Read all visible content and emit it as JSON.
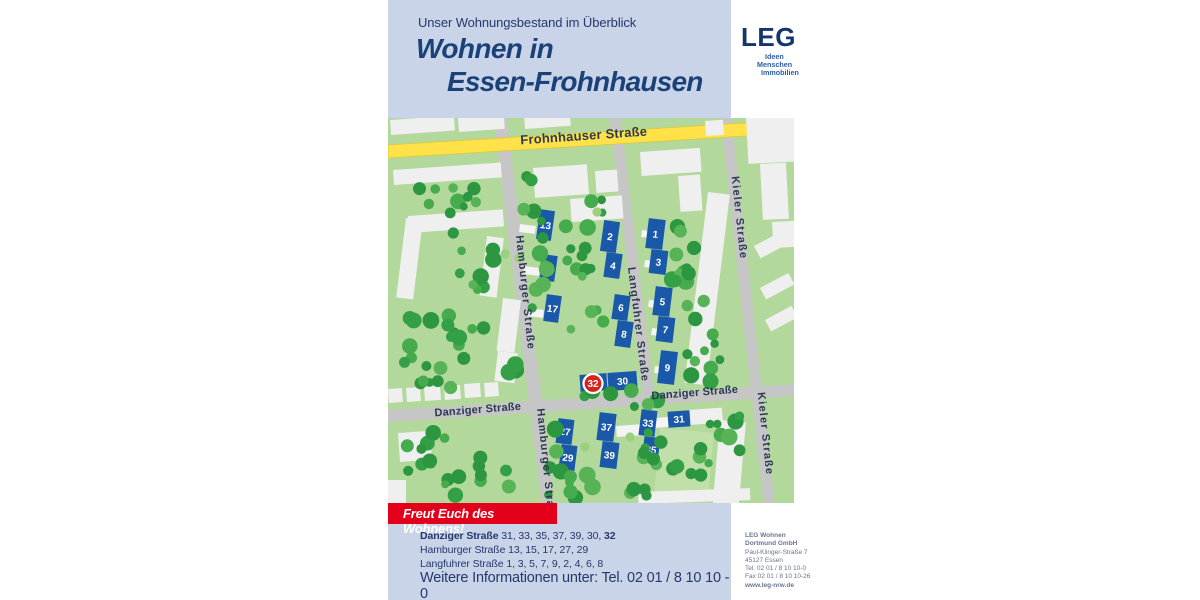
{
  "header": {
    "eyebrow": "Unser Wohnungsbestand im Überblick",
    "title_line1": "Wohnen in",
    "title_line2": "Essen-Frohnhausen"
  },
  "logo": {
    "name": "LEG",
    "tagline": [
      "Ideen",
      "Menschen",
      "Immobilien"
    ]
  },
  "map": {
    "street_labels": [
      {
        "text": "Frohnhauser Straße",
        "x": 196,
        "y": 22,
        "rot": -4,
        "size": 13,
        "main": true
      },
      {
        "text": "Hamburger Straße",
        "x": 134,
        "y": 175,
        "rot": 84,
        "size": 11
      },
      {
        "text": "Hamburger Straße",
        "x": 155,
        "y": 348,
        "rot": 84,
        "size": 11
      },
      {
        "text": "Langfuhrer Straße",
        "x": 247,
        "y": 207,
        "rot": 83,
        "size": 11
      },
      {
        "text": "Kieler Straße",
        "x": 348,
        "y": 100,
        "rot": 84,
        "size": 11
      },
      {
        "text": "Kieler Straße",
        "x": 374,
        "y": 316,
        "rot": 84,
        "size": 11
      },
      {
        "text": "Danziger Straße",
        "x": 90,
        "y": 295,
        "rot": -4.5,
        "size": 11,
        "horiz": true
      },
      {
        "text": "Danziger Straße",
        "x": 307,
        "y": 278,
        "rot": -4.5,
        "size": 11,
        "horiz": true
      }
    ],
    "buildings": [
      {
        "label": "13",
        "x": 150,
        "y": 92,
        "w": 15,
        "h": 30,
        "rot": 8
      },
      {
        "label": "15",
        "x": 153,
        "y": 137,
        "w": 15,
        "h": 26,
        "rot": 8
      },
      {
        "label": "17",
        "x": 157,
        "y": 177,
        "w": 15,
        "h": 27,
        "rot": 8
      },
      {
        "label": "2",
        "x": 214,
        "y": 103,
        "w": 16,
        "h": 31,
        "rot": 8
      },
      {
        "label": "4",
        "x": 217,
        "y": 135,
        "w": 16,
        "h": 25,
        "rot": 8
      },
      {
        "label": "6",
        "x": 225,
        "y": 177,
        "w": 16,
        "h": 25,
        "rot": 8
      },
      {
        "label": "8",
        "x": 228,
        "y": 203,
        "w": 16,
        "h": 26,
        "rot": 8
      },
      {
        "label": "1",
        "x": 259,
        "y": 101,
        "w": 17,
        "h": 30,
        "rot": 7
      },
      {
        "label": "3",
        "x": 262,
        "y": 132,
        "w": 17,
        "h": 24,
        "rot": 7
      },
      {
        "label": "5",
        "x": 266,
        "y": 169,
        "w": 17,
        "h": 29,
        "rot": 7
      },
      {
        "label": "7",
        "x": 269,
        "y": 199,
        "w": 17,
        "h": 25,
        "rot": 7
      },
      {
        "label": "9",
        "x": 271,
        "y": 233,
        "w": 17,
        "h": 33,
        "rot": 7
      },
      {
        "label": "",
        "x": 192,
        "y": 256,
        "w": 27,
        "h": 17,
        "rot": -4
      },
      {
        "label": "30",
        "x": 220,
        "y": 254,
        "w": 29,
        "h": 18,
        "rot": -4
      },
      {
        "label": "27",
        "x": 169,
        "y": 301,
        "w": 16,
        "h": 25,
        "rot": 7
      },
      {
        "label": "29",
        "x": 172,
        "y": 327,
        "w": 16,
        "h": 25,
        "rot": 7
      },
      {
        "label": "37",
        "x": 210,
        "y": 295,
        "w": 17,
        "h": 28,
        "rot": 7
      },
      {
        "label": "39",
        "x": 213,
        "y": 324,
        "w": 17,
        "h": 26,
        "rot": 7
      },
      {
        "label": "33",
        "x": 252,
        "y": 292,
        "w": 16,
        "h": 26,
        "rot": 7
      },
      {
        "label": "35",
        "x": 255,
        "y": 319,
        "w": 16,
        "h": 25,
        "rot": 7
      },
      {
        "label": "31",
        "x": 280,
        "y": 293,
        "w": 22,
        "h": 16,
        "rot": -4
      }
    ],
    "badge": {
      "label": "32",
      "x": 205,
      "y": 265.5,
      "r": 9.5
    }
  },
  "footer": {
    "banner": "Freut Euch des Wohnens!",
    "lines": [
      {
        "parts": [
          {
            "t": "Danziger Straße",
            "b": true
          },
          {
            "t": " 31, 33, 35, 37, 39, 30, ",
            "b": false
          },
          {
            "t": "32",
            "b": true
          }
        ]
      },
      {
        "parts": [
          {
            "t": "Hamburger Straße",
            "b": false
          },
          {
            "t": " 13, 15, 17, 27, 29",
            "b": false
          }
        ]
      },
      {
        "parts": [
          {
            "t": "Langfuhrer Straße",
            "b": false
          },
          {
            "t": " 1, 3, 5, 7, 9, 2, 4, 6, 8",
            "b": false
          }
        ]
      }
    ],
    "info": "Weitere Informationen unter: Tel. 02 01 / 8 10 10 - 0"
  },
  "contact": {
    "lines": [
      "LEG Wohnen",
      "Dortmund GmbH",
      "Paul-Klinger-Straße 7",
      "45127 Essen",
      "Tel. 02 01 / 8 10 10-0",
      "Fax 02 01 / 8 10 10-26",
      "www.leg-nrw.de"
    ],
    "bold_indices": [
      0,
      1,
      6
    ]
  },
  "colors": {
    "header_bg": "#c9d4e8",
    "navy": "#24386b",
    "title": "#1b4278",
    "red": "#e2001a",
    "badge_red": "#d7231e",
    "building": "#1a58a9",
    "map_green": "#b2d89b",
    "street_gray": "#c6c6c6",
    "yellow": "#ffe24a",
    "logo_navy": "#14356e",
    "logo_blue": "#2a5ea8",
    "contact_gray": "#6b7590"
  }
}
